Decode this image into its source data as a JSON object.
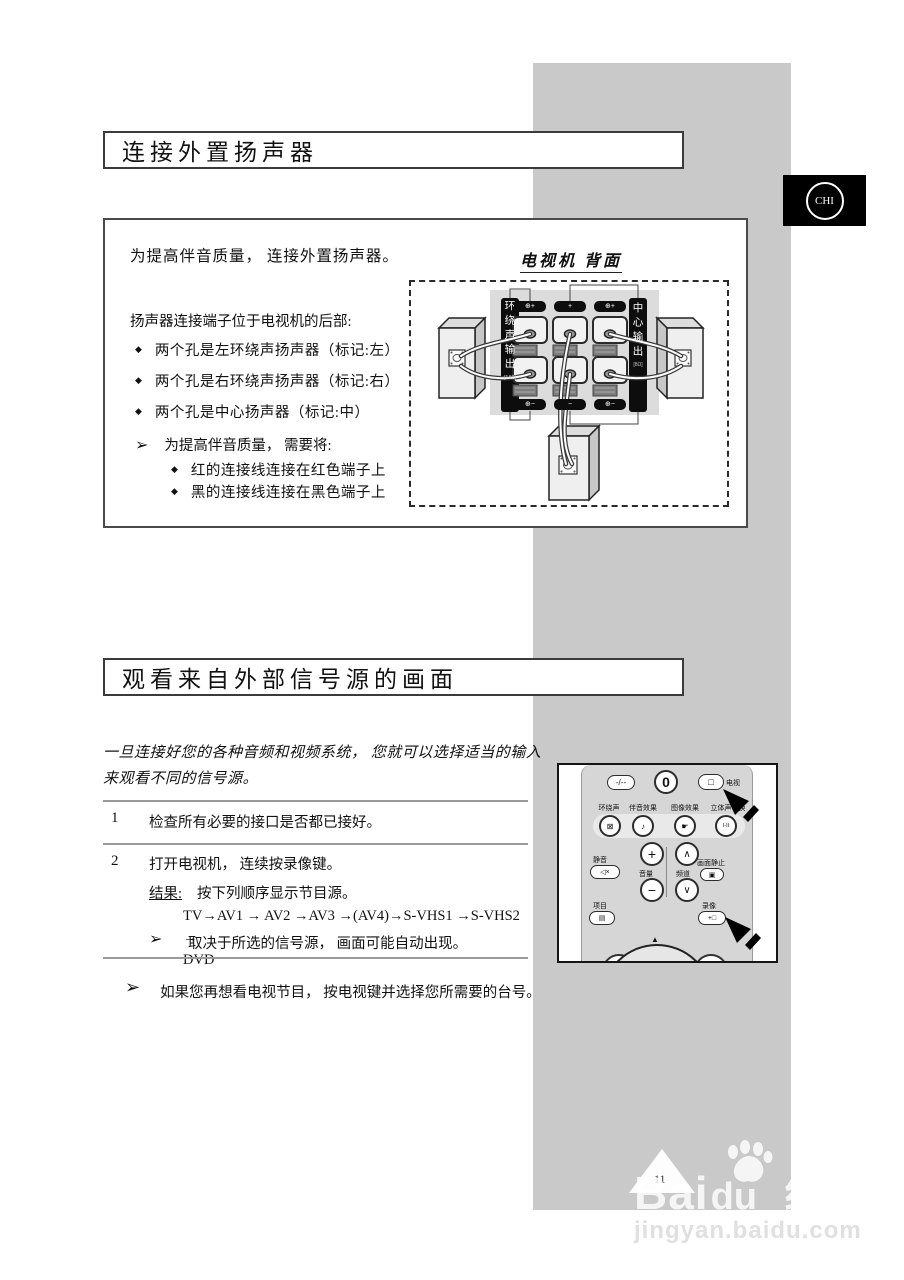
{
  "page": {
    "badge": "CHI",
    "page_number": "11"
  },
  "glyphs": {
    "bullet": "◆",
    "note_arrow": "➢"
  },
  "section1": {
    "title": "连接外置扬声器",
    "intro": "为提高伴音质量， 连接外置扬声器。",
    "location_text": "扬声器连接端子位于电视机的后部:",
    "bullets": [
      "两个孔是左环绕声扬声器（标记:左）",
      "两个孔是右环绕声扬声器（标记:右）",
      "两个孔是中心扬声器（标记:中）"
    ],
    "note_intro": "为提高伴音质量， 需要将:",
    "note_bullets": [
      "红的连接线连接在红色端子上",
      "黑的连接线连接在黑色端子上"
    ],
    "diagram": {
      "caption": "电视机 背面",
      "left_strip": "环绕声输出",
      "left_strip_small": "[1&2]",
      "right_strip": "中心输出",
      "right_strip_small": "[8Ω]",
      "pills_top": [
        "⊕+",
        "+",
        "⊕+"
      ],
      "pills_bottom": [
        "⊕−",
        "−",
        "⊕−"
      ]
    }
  },
  "section2": {
    "title": "观看来自外部信号源的画面",
    "intro": "一旦连接好您的各种音频和视频系统， 您就可以选择适当的输入来观看不同的信号源。",
    "step1_num": "1",
    "step1_text": "检查所有必要的接口是否都已接好。",
    "step2_num": "2",
    "step2_text": "打开电视机， 连续按录像键。",
    "result_label": "结果:",
    "result_text": "按下列顺序显示节目源。",
    "sequence_line1": "TV→AV1 → AV2 →AV3 →(AV4)→S-VHS1 →S-VHS2 →",
    "sequence_line2": "DVD",
    "step2_note": "取决于所选的信号源， 画面可能自动出现。",
    "footer_note": "如果您再想看电视节目， 按电视键并选择您所需要的台号。"
  },
  "remote": {
    "btn_dash": "-/--",
    "btn_zero": "0",
    "tv_icon": "□",
    "tv_label": "电视",
    "row2_labels": [
      "环绕声",
      "伴音效果",
      "图像效果",
      "立体声切换"
    ],
    "row2_icons": [
      "⊠",
      "♪",
      "☛",
      "I-II"
    ],
    "mute_label": "静音",
    "mute_icon": "◁×",
    "plus": "+",
    "minus": "−",
    "volume_label": "音量",
    "up": "∧",
    "down": "∨",
    "channel_label": "频道",
    "freeze_label": "画面静止",
    "freeze_icon": "▣",
    "menu_label": "项目",
    "menu_icon": "▤",
    "record_label": "录像",
    "record_icon": "+□",
    "nav_triangle": "▲"
  },
  "watermark": {
    "brand_bai": "Bai",
    "brand_du": "du",
    "brand_cn": "经验",
    "url": "jingyan.baidu.com"
  }
}
